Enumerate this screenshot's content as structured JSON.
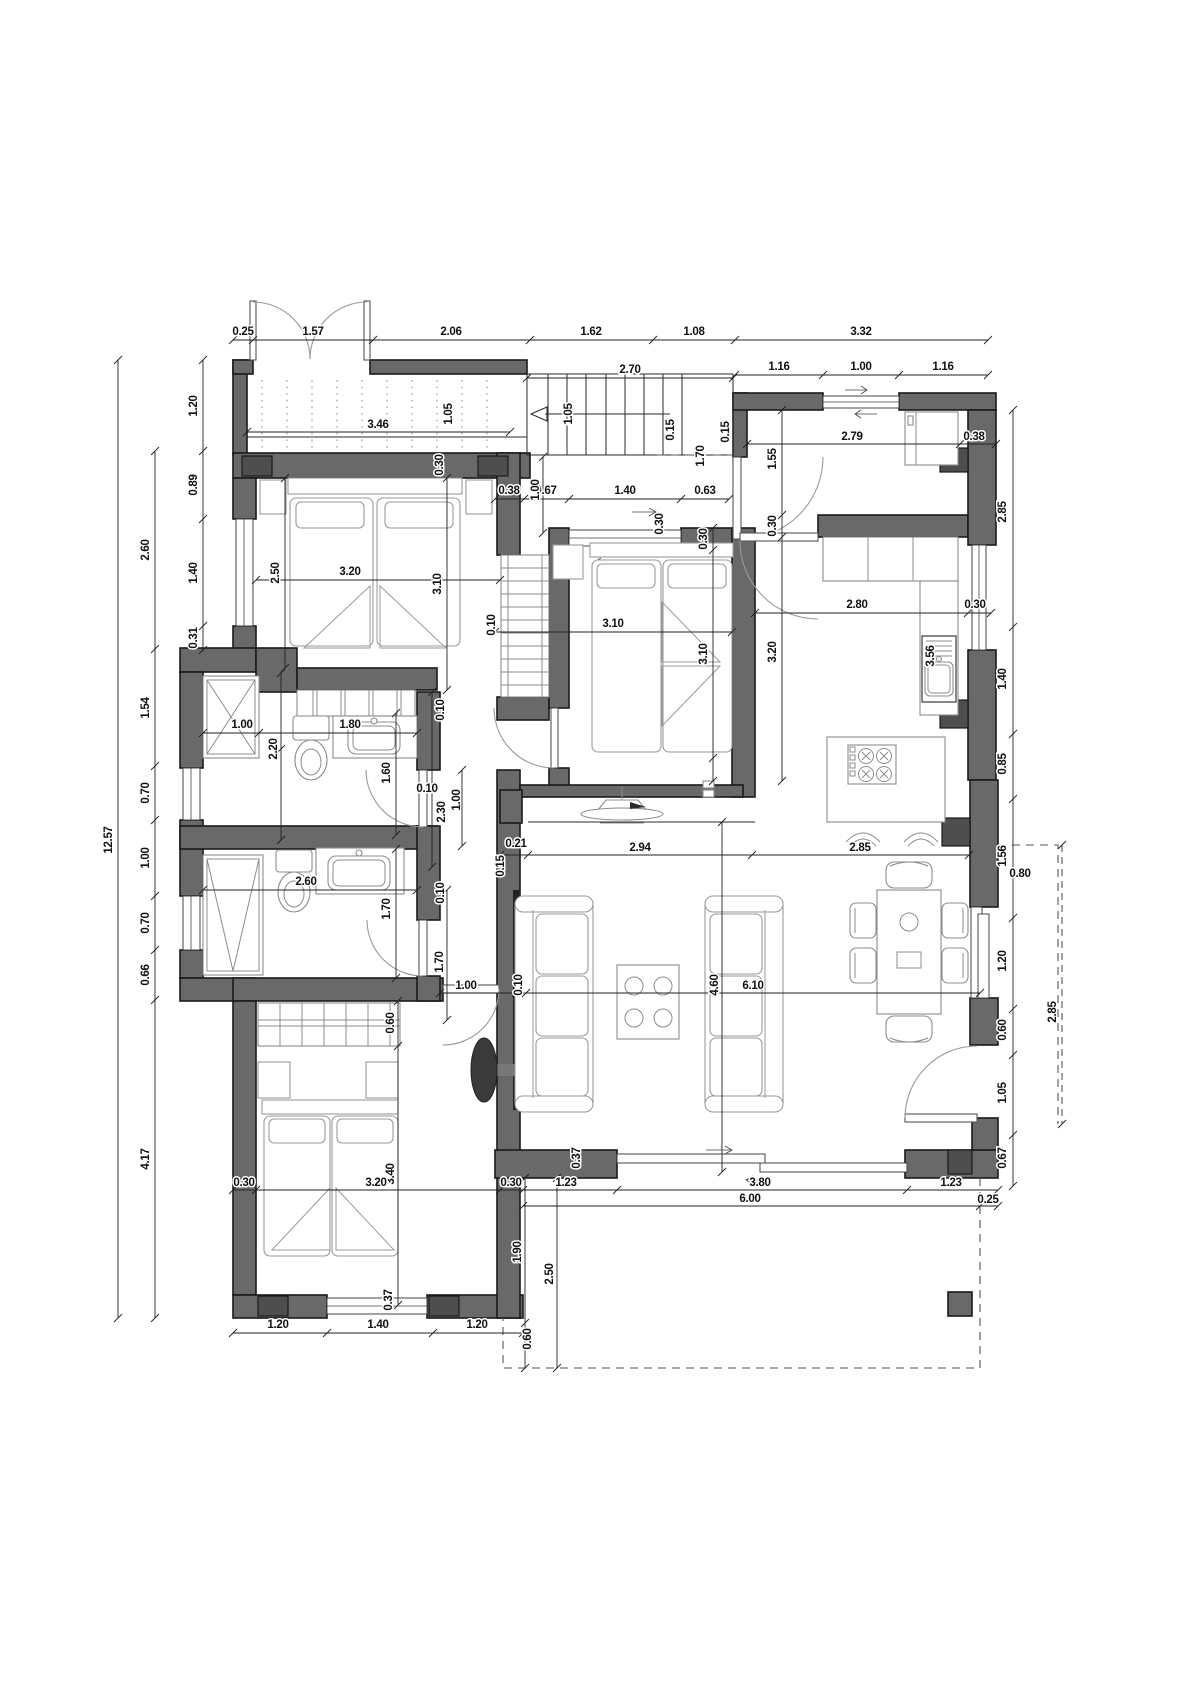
{
  "page": {
    "type": "architectural-floor-plan",
    "units": "meters",
    "background": "#ffffff"
  },
  "colors": {
    "wall": "#696969",
    "pier": "#4e4e4e",
    "line": "#222222",
    "furniture": "#8c8c8c",
    "text": "#111111"
  },
  "dimension_labels": [
    {
      "t": "0.25",
      "x": 243,
      "y": 335,
      "r": 0
    },
    {
      "t": "1.57",
      "x": 313,
      "y": 335,
      "r": 0
    },
    {
      "t": "2.06",
      "x": 451,
      "y": 335,
      "r": 0
    },
    {
      "t": "1.62",
      "x": 591,
      "y": 335,
      "r": 0
    },
    {
      "t": "1.08",
      "x": 694,
      "y": 335,
      "r": 0
    },
    {
      "t": "3.32",
      "x": 861,
      "y": 335,
      "r": 0
    },
    {
      "t": "2.70",
      "x": 630,
      "y": 373,
      "r": 0
    },
    {
      "t": "1.16",
      "x": 779,
      "y": 370,
      "r": 0
    },
    {
      "t": "1.00",
      "x": 861,
      "y": 370,
      "r": 0
    },
    {
      "t": "1.16",
      "x": 943,
      "y": 370,
      "r": 0
    },
    {
      "t": "1.05",
      "x": 452,
      "y": 414,
      "r": 1
    },
    {
      "t": "1.05",
      "x": 572,
      "y": 414,
      "r": 1
    },
    {
      "t": "3.46",
      "x": 378,
      "y": 428,
      "r": 0
    },
    {
      "t": "0.30",
      "x": 443,
      "y": 465,
      "r": 1
    },
    {
      "t": "12.57",
      "x": 112,
      "y": 840,
      "r": 1
    },
    {
      "t": "1.20",
      "x": 197,
      "y": 406,
      "r": 1
    },
    {
      "t": "0.89",
      "x": 197,
      "y": 485,
      "r": 1
    },
    {
      "t": "1.40",
      "x": 197,
      "y": 573,
      "r": 1
    },
    {
      "t": "0.31",
      "x": 197,
      "y": 638,
      "r": 1
    },
    {
      "t": "2.60",
      "x": 149,
      "y": 550,
      "r": 1
    },
    {
      "t": "1.54",
      "x": 149,
      "y": 708,
      "r": 1
    },
    {
      "t": "0.70",
      "x": 149,
      "y": 793,
      "r": 1
    },
    {
      "t": "1.00",
      "x": 149,
      "y": 858,
      "r": 1
    },
    {
      "t": "0.70",
      "x": 149,
      "y": 923,
      "r": 1
    },
    {
      "t": "0.66",
      "x": 149,
      "y": 975,
      "r": 1
    },
    {
      "t": "4.17",
      "x": 149,
      "y": 1159,
      "r": 1
    },
    {
      "t": "2.50",
      "x": 279,
      "y": 573,
      "r": 1
    },
    {
      "t": "3.10",
      "x": 441,
      "y": 584,
      "r": 1
    },
    {
      "t": "3.20",
      "x": 350,
      "y": 575,
      "r": 0
    },
    {
      "t": "0.38",
      "x": 509,
      "y": 494,
      "r": 0
    },
    {
      "t": "0.67",
      "x": 546,
      "y": 494,
      "r": 0
    },
    {
      "t": "1.40",
      "x": 625,
      "y": 494,
      "r": 0
    },
    {
      "t": "0.63",
      "x": 705,
      "y": 494,
      "r": 0
    },
    {
      "t": "1.00",
      "x": 539,
      "y": 490,
      "r": 1
    },
    {
      "t": "0.10",
      "x": 495,
      "y": 625,
      "r": 1
    },
    {
      "t": "3.10",
      "x": 613,
      "y": 627,
      "r": 0
    },
    {
      "t": "0.30",
      "x": 707,
      "y": 539,
      "r": 1
    },
    {
      "t": "3.10",
      "x": 707,
      "y": 654,
      "r": 1
    },
    {
      "t": "0.30",
      "x": 663,
      "y": 524,
      "r": 1
    },
    {
      "t": "0.15",
      "x": 674,
      "y": 430,
      "r": 1
    },
    {
      "t": "1.70",
      "x": 704,
      "y": 456,
      "r": 1
    },
    {
      "t": "0.15",
      "x": 729,
      "y": 432,
      "r": 1
    },
    {
      "t": "2.79",
      "x": 852,
      "y": 440,
      "r": 0
    },
    {
      "t": "0.38",
      "x": 974,
      "y": 440,
      "r": 0
    },
    {
      "t": "1.55",
      "x": 776,
      "y": 459,
      "r": 1
    },
    {
      "t": "0.30",
      "x": 776,
      "y": 526,
      "r": 1
    },
    {
      "t": "2.80",
      "x": 857,
      "y": 608,
      "r": 0
    },
    {
      "t": "0.30",
      "x": 975,
      "y": 608,
      "r": 0
    },
    {
      "t": "3.20",
      "x": 776,
      "y": 652,
      "r": 1
    },
    {
      "t": "3.56",
      "x": 934,
      "y": 656,
      "r": 1
    },
    {
      "t": "2.85",
      "x": 1006,
      "y": 512,
      "r": 1
    },
    {
      "t": "1.40",
      "x": 1006,
      "y": 679,
      "r": 1
    },
    {
      "t": "0.85",
      "x": 1006,
      "y": 764,
      "r": 1
    },
    {
      "t": "1.56",
      "x": 1006,
      "y": 856,
      "r": 1
    },
    {
      "t": "0.80",
      "x": 1020,
      "y": 877,
      "r": 0
    },
    {
      "t": "1.20",
      "x": 1006,
      "y": 961,
      "r": 1
    },
    {
      "t": "0.60",
      "x": 1006,
      "y": 1030,
      "r": 1
    },
    {
      "t": "1.05",
      "x": 1006,
      "y": 1093,
      "r": 1
    },
    {
      "t": "0.67",
      "x": 1006,
      "y": 1158,
      "r": 1
    },
    {
      "t": "2.85",
      "x": 1056,
      "y": 1012,
      "r": 1
    },
    {
      "t": "1.00",
      "x": 242,
      "y": 728,
      "r": 0
    },
    {
      "t": "1.80",
      "x": 350,
      "y": 728,
      "r": 0
    },
    {
      "t": "2.20",
      "x": 277,
      "y": 749,
      "r": 1
    },
    {
      "t": "1.60",
      "x": 390,
      "y": 773,
      "r": 1
    },
    {
      "t": "0.10",
      "x": 427,
      "y": 792,
      "r": 0
    },
    {
      "t": "2.30",
      "x": 445,
      "y": 812,
      "r": 1
    },
    {
      "t": "1.00",
      "x": 460,
      "y": 800,
      "r": 1
    },
    {
      "t": "0.10",
      "x": 444,
      "y": 710,
      "r": 1
    },
    {
      "t": "2.60",
      "x": 306,
      "y": 885,
      "r": 0
    },
    {
      "t": "1.70",
      "x": 390,
      "y": 909,
      "r": 1
    },
    {
      "t": "0.10",
      "x": 444,
      "y": 893,
      "r": 1
    },
    {
      "t": "0.21",
      "x": 516,
      "y": 847,
      "r": 0
    },
    {
      "t": "0.15",
      "x": 504,
      "y": 866,
      "r": 1
    },
    {
      "t": "2.94",
      "x": 640,
      "y": 851,
      "r": 0
    },
    {
      "t": "2.85",
      "x": 860,
      "y": 851,
      "r": 0
    },
    {
      "t": "1.70",
      "x": 443,
      "y": 962,
      "r": 1
    },
    {
      "t": "4.60",
      "x": 718,
      "y": 985,
      "r": 1
    },
    {
      "t": "1.00",
      "x": 466,
      "y": 989,
      "r": 0
    },
    {
      "t": "0.10",
      "x": 522,
      "y": 985,
      "r": 1
    },
    {
      "t": "6.10",
      "x": 753,
      "y": 989,
      "r": 0
    },
    {
      "t": "0.60",
      "x": 394,
      "y": 1023,
      "r": 1
    },
    {
      "t": "3.40",
      "x": 394,
      "y": 1174,
      "r": 1
    },
    {
      "t": "0.30",
      "x": 244,
      "y": 1186,
      "r": 0
    },
    {
      "t": "3.20",
      "x": 376,
      "y": 1186,
      "r": 0
    },
    {
      "t": "0.30",
      "x": 511,
      "y": 1186,
      "r": 0
    },
    {
      "t": "0.37",
      "x": 580,
      "y": 1158,
      "r": 1
    },
    {
      "t": "1.23",
      "x": 566,
      "y": 1186,
      "r": 0
    },
    {
      "t": "3.80",
      "x": 760,
      "y": 1186,
      "r": 0
    },
    {
      "t": "1.23",
      "x": 951,
      "y": 1186,
      "r": 0
    },
    {
      "t": "6.00",
      "x": 750,
      "y": 1202,
      "r": 0
    },
    {
      "t": "0.25",
      "x": 988,
      "y": 1203,
      "r": 0
    },
    {
      "t": "1.90",
      "x": 521,
      "y": 1252,
      "r": 1
    },
    {
      "t": "2.50",
      "x": 553,
      "y": 1274,
      "r": 1
    },
    {
      "t": "0.60",
      "x": 531,
      "y": 1339,
      "r": 1
    },
    {
      "t": "1.20",
      "x": 278,
      "y": 1328,
      "r": 0
    },
    {
      "t": "1.40",
      "x": 378,
      "y": 1328,
      "r": 0
    },
    {
      "t": "1.20",
      "x": 477,
      "y": 1328,
      "r": 0
    },
    {
      "t": "0.37",
      "x": 392,
      "y": 1300,
      "r": 1
    }
  ],
  "dimension_lines": [
    {
      "o": "h",
      "p": 340,
      "a": 233,
      "b": 988,
      "ticks": [
        233,
        253,
        373,
        530,
        653,
        735,
        988
      ]
    },
    {
      "o": "h",
      "p": 375,
      "a": 735,
      "b": 988,
      "ticks": [
        735,
        823,
        899,
        988
      ]
    },
    {
      "o": "h",
      "p": 378,
      "a": 527,
      "b": 733,
      "ticks": [
        527,
        733
      ]
    },
    {
      "o": "h",
      "p": 432,
      "a": 247,
      "b": 510,
      "ticks": [
        247,
        510
      ]
    },
    {
      "o": "h",
      "p": 499,
      "a": 495,
      "b": 729,
      "ticks": [
        495,
        524,
        569,
        681,
        729
      ]
    },
    {
      "o": "h",
      "p": 444,
      "a": 747,
      "b": 996,
      "ticks": [
        747,
        960,
        996
      ]
    },
    {
      "o": "h",
      "p": 580,
      "a": 256,
      "b": 500,
      "ticks": [
        256,
        500
      ]
    },
    {
      "o": "h",
      "p": 613,
      "a": 755,
      "b": 991,
      "ticks": [
        755,
        968,
        991
      ]
    },
    {
      "o": "h",
      "p": 632,
      "a": 495,
      "b": 732,
      "ticks": [
        495,
        732
      ]
    },
    {
      "o": "h",
      "p": 733,
      "a": 203,
      "b": 417,
      "ticks": [
        203,
        259,
        417
      ]
    },
    {
      "o": "h",
      "p": 855,
      "a": 500,
      "b": 969,
      "ticks": [
        500,
        528,
        752,
        969
      ]
    },
    {
      "o": "h",
      "p": 890,
      "a": 203,
      "b": 417,
      "ticks": [
        203,
        417
      ]
    },
    {
      "o": "h",
      "p": 993,
      "a": 440,
      "b": 980,
      "ticks": [
        440,
        516,
        526,
        980
      ]
    },
    {
      "o": "h",
      "p": 1190,
      "a": 233,
      "b": 998,
      "ticks": [
        233,
        256,
        500,
        523,
        617,
        907,
        998
      ]
    },
    {
      "o": "h",
      "p": 1206,
      "a": 523,
      "b": 998,
      "ticks": [
        523,
        980,
        998
      ]
    },
    {
      "o": "h",
      "p": 1333,
      "a": 233,
      "b": 523,
      "ticks": [
        233,
        327,
        433,
        523
      ]
    },
    {
      "o": "v",
      "p": 118,
      "a": 360,
      "b": 1318,
      "ticks": [
        360,
        1318
      ]
    },
    {
      "o": "v",
      "p": 155,
      "a": 451,
      "b": 1318,
      "ticks": [
        451,
        649,
        766,
        820,
        896,
        950,
        1000,
        1318
      ]
    },
    {
      "o": "v",
      "p": 203,
      "a": 360,
      "b": 650,
      "ticks": [
        360,
        451,
        519,
        626,
        650
      ]
    },
    {
      "o": "v",
      "p": 285,
      "a": 478,
      "b": 668,
      "ticks": [
        478,
        668
      ]
    },
    {
      "o": "v",
      "p": 447,
      "a": 478,
      "b": 690,
      "ticks": [
        478,
        690
      ]
    },
    {
      "o": "v",
      "p": 543,
      "a": 457,
      "b": 533,
      "ticks": [
        457,
        533
      ]
    },
    {
      "o": "v",
      "p": 713,
      "a": 528,
      "b": 781,
      "ticks": [
        528,
        550,
        758,
        781
      ]
    },
    {
      "o": "v",
      "p": 782,
      "a": 410,
      "b": 781,
      "ticks": [
        410,
        515,
        537,
        781
      ]
    },
    {
      "o": "v",
      "p": 1013,
      "a": 410,
      "b": 1186,
      "ticks": [
        410,
        627,
        734,
        799,
        918,
        1009,
        1055,
        1135,
        1186
      ]
    },
    {
      "o": "v",
      "p": 1062,
      "a": 845,
      "b": 1124,
      "ticks": [
        845,
        1124
      ],
      "dash": true
    },
    {
      "o": "v",
      "p": 281,
      "a": 673,
      "b": 840,
      "ticks": [
        673,
        749,
        840
      ]
    },
    {
      "o": "v",
      "p": 396,
      "a": 713,
      "b": 835,
      "ticks": [
        713,
        835
      ]
    },
    {
      "o": "v",
      "p": 396,
      "a": 849,
      "b": 978,
      "ticks": [
        849,
        978
      ]
    },
    {
      "o": "v",
      "p": 432,
      "a": 692,
      "b": 867,
      "ticks": [
        692,
        867
      ]
    },
    {
      "o": "v",
      "p": 462,
      "a": 770,
      "b": 846,
      "ticks": [
        770,
        846
      ]
    },
    {
      "o": "v",
      "p": 447,
      "a": 890,
      "b": 1020,
      "ticks": [
        890,
        1020
      ]
    },
    {
      "o": "v",
      "p": 398,
      "a": 1001,
      "b": 1305,
      "ticks": [
        1001,
        1046,
        1305
      ]
    },
    {
      "o": "v",
      "p": 525,
      "a": 1178,
      "b": 1368,
      "ticks": [
        1178,
        1323,
        1368
      ]
    },
    {
      "o": "v",
      "p": 557,
      "a": 1178,
      "b": 1368,
      "ticks": [
        1178,
        1368
      ]
    },
    {
      "o": "v",
      "p": 722,
      "a": 822,
      "b": 1172,
      "ticks": [
        822,
        1172
      ]
    }
  ]
}
